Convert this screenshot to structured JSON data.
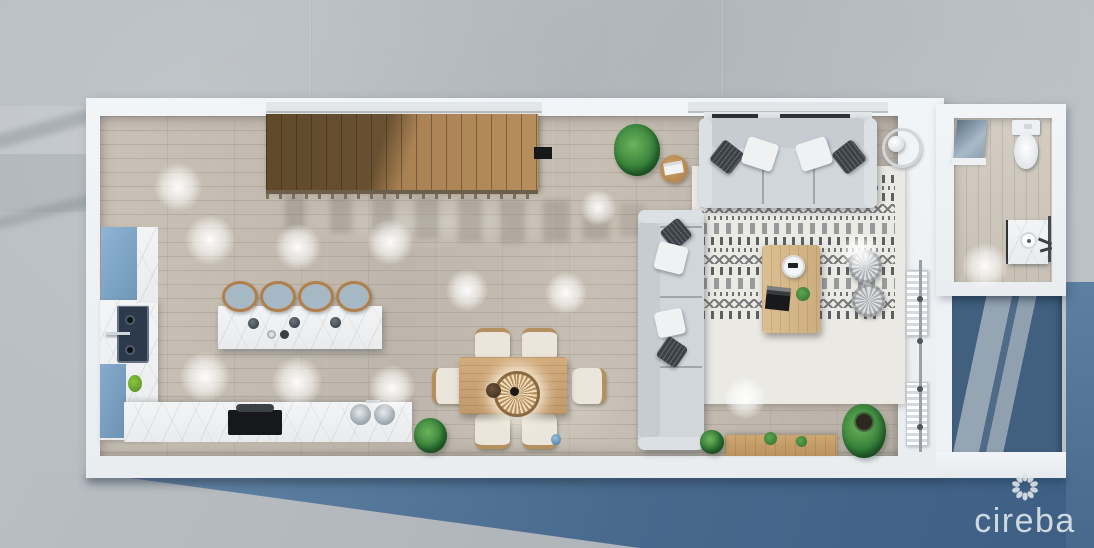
{
  "watermark": {
    "text": "cireba",
    "icon": "petal-ring-flower-icon",
    "color": "#d8dfe4"
  },
  "scene": {
    "type": "top-down 3D floor plan render",
    "rooms": [
      "kitchen",
      "dining area",
      "living room",
      "staircase",
      "bathroom",
      "terrace"
    ],
    "furniture": [
      "wooden staircase with railing",
      "blue tall cabinet",
      "navy double kitchen sink",
      "marble L-counter with cooktop and round twin sink",
      "kitchen island with 4 bar stools",
      "dining table with 6 chairs and rattan pendant light",
      "three-seat sofa with pillows",
      "two-seat sofa with pillows",
      "patterned area rug",
      "coffee table with tray, book and plant",
      "two woven poufs",
      "ring floor lamp",
      "potted plants",
      "wooden bench",
      "toilet",
      "glass shower panel",
      "vanity sink"
    ]
  },
  "palette": {
    "concrete": "#b8bec2",
    "water_blue": "#47688c",
    "wall_white": "#f0f3f5",
    "floor_wood": "#c6beb2",
    "stair_wood": "#a57f55",
    "cabinet_blue": "#7ea6c8",
    "sofa_gray": "#d1d6db",
    "rug_pattern": "#3a3d42",
    "dining_wood": "#c9a478",
    "plant_green": "#37823b"
  }
}
